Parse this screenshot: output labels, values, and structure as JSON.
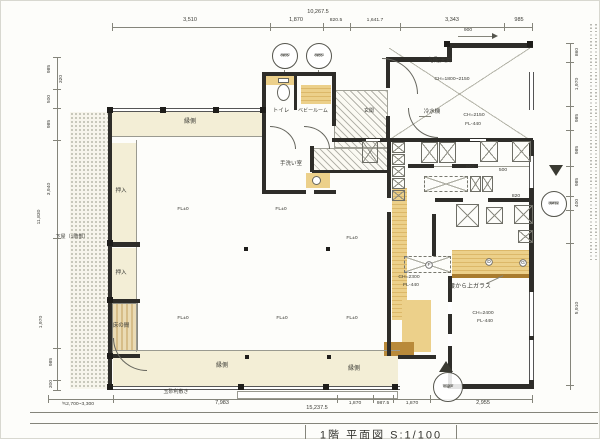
{
  "colors": {
    "paper": "#fdfdfa",
    "cream_floor": "#f3eed6",
    "tan_counter": "#ecd08a",
    "wood_brown": "#b98a3a",
    "wall": "#2e2d29",
    "dim_line": "#85857b"
  },
  "title": {
    "text": "1階 平面図 S:1/100"
  },
  "labels": {
    "rooms": [
      {
        "t": "縁側",
        "x": 190,
        "y": 122,
        "fs": 6
      },
      {
        "t": "トイレ",
        "x": 281,
        "y": 111,
        "fs": 5.5
      },
      {
        "t": "ベビールーム",
        "x": 313,
        "y": 111,
        "fs": 5
      },
      {
        "t": "玄関",
        "x": 369,
        "y": 111,
        "fs": 5
      },
      {
        "t": "手洗い室",
        "x": 291,
        "y": 164,
        "fs": 5.5
      },
      {
        "t": "勾配天井",
        "x": 440,
        "y": 61,
        "fs": 6
      },
      {
        "t": "冷水機",
        "x": 432,
        "y": 112,
        "fs": 5.5
      },
      {
        "t": "押入",
        "x": 121,
        "y": 191,
        "fs": 5.5
      },
      {
        "t": "押入",
        "x": 121,
        "y": 273,
        "fs": 5.5
      },
      {
        "t": "床の間",
        "x": 121,
        "y": 326,
        "fs": 5.5
      },
      {
        "t": "下屋（1階部）",
        "x": 72,
        "y": 237,
        "fs": 5
      },
      {
        "t": "縁側",
        "x": 222,
        "y": 366,
        "fs": 6
      },
      {
        "t": "縁側",
        "x": 354,
        "y": 369,
        "fs": 6
      },
      {
        "t": "玉砂利敷き",
        "x": 176,
        "y": 392,
        "fs": 5
      },
      {
        "t": "腰から上ガラス",
        "x": 470,
        "y": 287,
        "fs": 6
      }
    ],
    "annotations": [
      {
        "t": "CH=1800~2150",
        "x": 452,
        "y": 79,
        "fs": 5
      },
      {
        "t": "CH=2150",
        "x": 474,
        "y": 115,
        "fs": 5
      },
      {
        "t": "FL-440",
        "x": 473,
        "y": 124,
        "fs": 5
      },
      {
        "t": "CH=2300",
        "x": 409,
        "y": 277,
        "fs": 5
      },
      {
        "t": "FL-440",
        "x": 411,
        "y": 285,
        "fs": 5
      },
      {
        "t": "CH=2400",
        "x": 483,
        "y": 313,
        "fs": 5
      },
      {
        "t": "FL-440",
        "x": 485,
        "y": 321,
        "fs": 5
      },
      {
        "t": "FL±0",
        "x": 183,
        "y": 209,
        "fs": 5
      },
      {
        "t": "FL±0",
        "x": 281,
        "y": 209,
        "fs": 5
      },
      {
        "t": "FL±0",
        "x": 352,
        "y": 238,
        "fs": 5
      },
      {
        "t": "FL±0",
        "x": 183,
        "y": 318,
        "fs": 5
      },
      {
        "t": "FL±0",
        "x": 282,
        "y": 318,
        "fs": 5
      },
      {
        "t": "FL±0",
        "x": 352,
        "y": 318,
        "fs": 5
      }
    ],
    "equipment_letters": [
      {
        "t": "D",
        "x": 489,
        "y": 262,
        "fs": 5,
        "cls": "circ"
      },
      {
        "t": "F",
        "x": 429,
        "y": 265,
        "fs": 5,
        "cls": "circ"
      },
      {
        "t": "G",
        "x": 523,
        "y": 263,
        "fs": 5,
        "cls": "circ"
      }
    ],
    "dims_top": [
      {
        "t": "10,267.5",
        "x": 318,
        "y": 12,
        "fs": 5.5
      },
      {
        "t": "3,510",
        "x": 190,
        "y": 20,
        "fs": 5.5
      },
      {
        "t": "1,870",
        "x": 296,
        "y": 20,
        "fs": 5.5
      },
      {
        "t": "820.5",
        "x": 336,
        "y": 20,
        "fs": 5
      },
      {
        "t": "1,641.7",
        "x": 375,
        "y": 20,
        "fs": 5
      },
      {
        "t": "3,343",
        "x": 452,
        "y": 20,
        "fs": 5.5
      },
      {
        "t": "985",
        "x": 519,
        "y": 20,
        "fs": 5.5
      },
      {
        "t": "900",
        "x": 468,
        "y": 30,
        "fs": 5
      }
    ],
    "dims_left": [
      {
        "t": "985",
        "x": 49,
        "y": 69,
        "fs": 5,
        "rot": -90
      },
      {
        "t": "320",
        "x": 61,
        "y": 79,
        "fs": 5,
        "rot": -90
      },
      {
        "t": "500",
        "x": 49,
        "y": 99,
        "fs": 5,
        "rot": -90
      },
      {
        "t": "985",
        "x": 49,
        "y": 124,
        "fs": 5,
        "rot": -90
      },
      {
        "t": "3,940",
        "x": 49,
        "y": 189,
        "fs": 5,
        "rot": -90
      },
      {
        "t": "11,830",
        "x": 39,
        "y": 217,
        "fs": 5,
        "rot": -90
      },
      {
        "t": "1,970",
        "x": 41,
        "y": 322,
        "fs": 5,
        "rot": -90
      },
      {
        "t": "985",
        "x": 51,
        "y": 362,
        "fs": 5,
        "rot": -90
      },
      {
        "t": "300",
        "x": 51,
        "y": 384,
        "fs": 5,
        "rot": -90
      }
    ],
    "dims_right": [
      {
        "t": "860",
        "x": 577,
        "y": 52,
        "fs": 5,
        "rot": -90
      },
      {
        "t": "1,970",
        "x": 577,
        "y": 84,
        "fs": 5,
        "rot": -90
      },
      {
        "t": "985",
        "x": 577,
        "y": 118,
        "fs": 5,
        "rot": -90
      },
      {
        "t": "985",
        "x": 577,
        "y": 150,
        "fs": 5,
        "rot": -90
      },
      {
        "t": "985",
        "x": 577,
        "y": 182,
        "fs": 5,
        "rot": -90
      },
      {
        "t": "400",
        "x": 577,
        "y": 203,
        "fs": 5,
        "rot": -90
      },
      {
        "t": "5,910",
        "x": 577,
        "y": 308,
        "fs": 5,
        "rot": -90
      }
    ],
    "dims_bottom": [
      {
        "t": "≒2,700~3,300",
        "x": 78,
        "y": 404,
        "fs": 5
      },
      {
        "t": "7,983",
        "x": 222,
        "y": 403,
        "fs": 5.5
      },
      {
        "t": "1,870",
        "x": 355,
        "y": 403,
        "fs": 5
      },
      {
        "t": "987.5",
        "x": 383,
        "y": 403,
        "fs": 5
      },
      {
        "t": "1,870",
        "x": 412,
        "y": 403,
        "fs": 5
      },
      {
        "t": "2,955",
        "x": 483,
        "y": 403,
        "fs": 5.5
      },
      {
        "t": "15,237.5",
        "x": 317,
        "y": 408,
        "fs": 5.5
      }
    ],
    "dims_inner": [
      {
        "t": "900",
        "x": 470,
        "y": 167,
        "fs": 5
      },
      {
        "t": "500",
        "x": 503,
        "y": 170,
        "fs": 5
      },
      {
        "t": "820",
        "x": 516,
        "y": 196,
        "fs": 5
      }
    ]
  },
  "tags": [
    {
      "name": "window-tag",
      "lines": [
        "AW02",
        "0805"
      ],
      "x": 285,
      "y": 56,
      "r": 13
    },
    {
      "name": "window-tag",
      "lines": [
        "AW03",
        "0855"
      ],
      "x": 319,
      "y": 56,
      "r": 13
    },
    {
      "name": "window-tag",
      "lines": [
        "AW02",
        "0841E"
      ],
      "x": 554,
      "y": 204,
      "r": 13
    },
    {
      "name": "door-tag",
      "lines": [
        "30-31",
        "引違戸"
      ],
      "x": 448,
      "y": 387,
      "r": 15
    }
  ]
}
